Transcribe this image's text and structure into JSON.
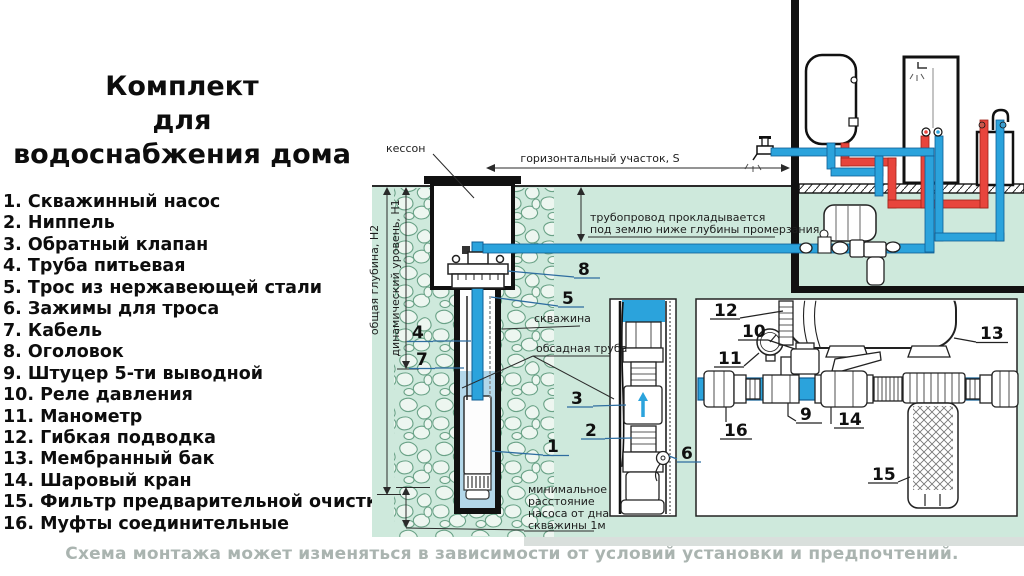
{
  "title": {
    "line1": "Комплект",
    "line2": "для",
    "line3": "водоснабжения дома"
  },
  "parts": [
    {
      "num": "1.",
      "label": "Скважинный насос"
    },
    {
      "num": "2.",
      "label": "Ниппель"
    },
    {
      "num": "3.",
      "label": "Обратный клапан"
    },
    {
      "num": "4.",
      "label": "Труба питьевая"
    },
    {
      "num": "5.",
      "label": "Трос из нержавеющей стали"
    },
    {
      "num": "6.",
      "label": "Зажимы для троса"
    },
    {
      "num": "7.",
      "label": "Кабель"
    },
    {
      "num": "8.",
      "label": "Оголовок"
    },
    {
      "num": "9.",
      "label": "Штуцер 5-ти выводной"
    },
    {
      "num": "10.",
      "label": "Реле давления"
    },
    {
      "num": "11.",
      "label": "Манометр"
    },
    {
      "num": "12.",
      "label": "Гибкая подводка"
    },
    {
      "num": "13.",
      "label": "Мембранный бак"
    },
    {
      "num": "14.",
      "label": "Шаровый кран"
    },
    {
      "num": "15.",
      "label": "Фильтр предварительной очистки"
    },
    {
      "num": "16.",
      "label": "Муфты соединительные"
    }
  ],
  "footer": "Схема монтажа может изменяться в зависимости от условий установки и предпочтений.",
  "diagram": {
    "labels": {
      "kesson": "кессон",
      "horizontal": "горизонтальный участок, S",
      "pipeline1": "трубопровод прокладывается",
      "pipeline2": "под землю ниже глубины промерзания",
      "depth_total": "общая глубина, Н2",
      "dynamic_level": "динамический уровень, Н1",
      "well": "скважина",
      "casing": "обсадная труба",
      "min1": "минимальное",
      "min2": "расстояние",
      "min3": "насоса от дна",
      "min4": "скважины 1м"
    },
    "callouts": {
      "c1": "1",
      "c2": "2",
      "c3": "3",
      "c4": "4",
      "c5": "5",
      "c6": "6",
      "c7": "7",
      "c8": "8",
      "c9": "9",
      "c10": "10",
      "c11": "11",
      "c12": "12",
      "c13": "13",
      "c14": "14",
      "c15": "15",
      "c16": "16"
    }
  },
  "colors": {
    "ground_green": "#cee9dc",
    "pipe_cold_blue": "#2ba3dc",
    "pipe_hot_red": "#e8453c",
    "well_water_blue": "#b3d7e9",
    "caption_gray": "#aab4b0"
  }
}
